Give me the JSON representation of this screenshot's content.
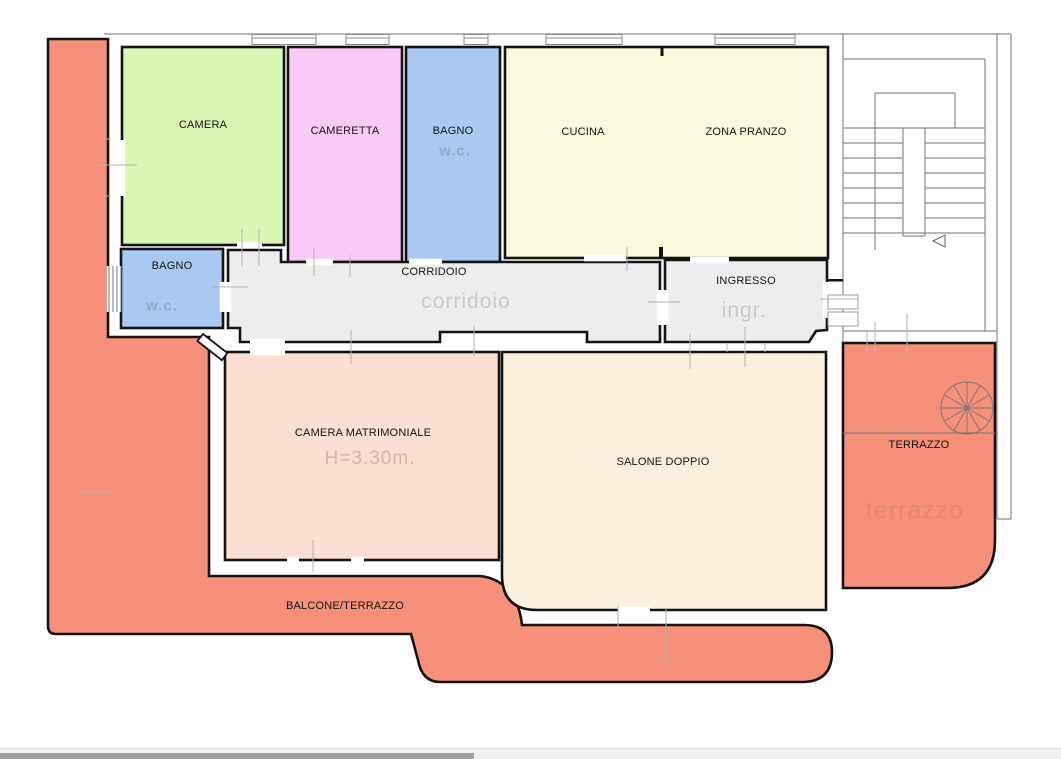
{
  "plan": {
    "rooms": {
      "camera": {
        "label": "CAMERA"
      },
      "cameretta": {
        "label": "CAMERETTA"
      },
      "bagno_top": {
        "label": "BAGNO",
        "sublabel": "w.c."
      },
      "cucina": {
        "label": "CUCINA"
      },
      "zona_pranzo": {
        "label": "ZONA PRANZO"
      },
      "bagno_left": {
        "label": "BAGNO",
        "sublabel": "w.c."
      },
      "corridoio": {
        "label": "CORRIDOIO",
        "sublabel": "corridoio"
      },
      "ingresso": {
        "label": "INGRESSO",
        "sublabel": "ingr."
      },
      "camera_matrimoniale": {
        "label": "CAMERA MATRIMONIALE",
        "sublabel": "H=3.30m."
      },
      "salone": {
        "label": "SALONE DOPPIO"
      },
      "balcone": {
        "label": "BALCONE/TERRAZZO"
      },
      "terrazzo": {
        "label": "TERRAZZO",
        "sublabel": "terrazzo"
      }
    },
    "colors": {
      "camera_green": "#d9f6b4",
      "cameretta_pink": "#fbc9f6",
      "bagno_blue": "#a9c9f2",
      "cucina_yellow": "#f8fadb",
      "corridoio_gray": "#ededed",
      "matrimoniale_peach": "#fbdfd2",
      "salone_cream": "#faf0dd",
      "terrace_salmon": "#f6907a",
      "wall_black": "#141414",
      "outline_gray": "#8c8c8c"
    }
  },
  "scrollbar": {
    "orientation": "horizontal"
  }
}
